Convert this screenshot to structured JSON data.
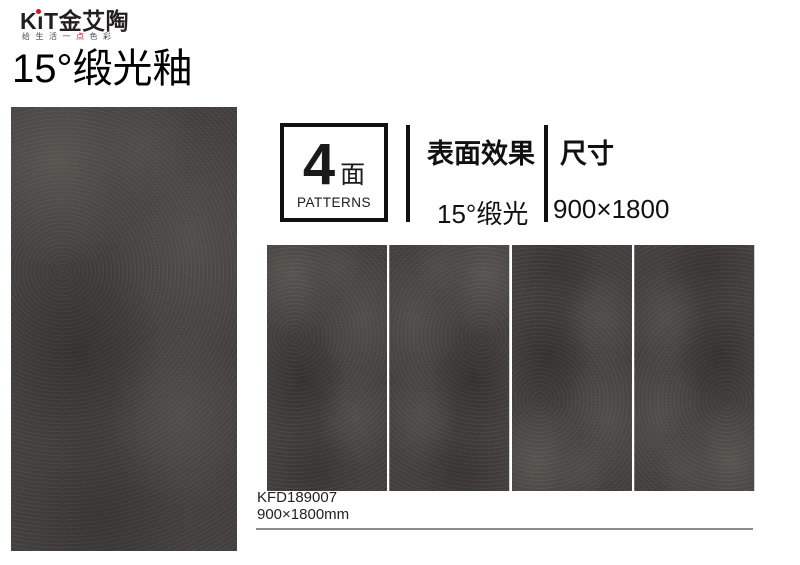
{
  "brand": {
    "logo_prefix": "K",
    "logo_i": "ı",
    "logo_suffix": "T",
    "logo_cn": "金艾陶",
    "tagline_left": "给生活一",
    "tagline_accent": "点",
    "tagline_right": "色彩",
    "accent_color": "#cf1225"
  },
  "title": "15°缎光釉",
  "specs": {
    "patterns_count": "4",
    "patterns_unit": "面",
    "patterns_caption": "PATTERNS",
    "surface": {
      "label": "表面效果",
      "value": "15°缎光"
    },
    "size": {
      "label": "尺寸",
      "value": "900×1800"
    }
  },
  "product": {
    "code": "KFD189007",
    "size": "900×1800mm"
  },
  "swatches": {
    "count": 4,
    "tile_color": "#454240"
  }
}
